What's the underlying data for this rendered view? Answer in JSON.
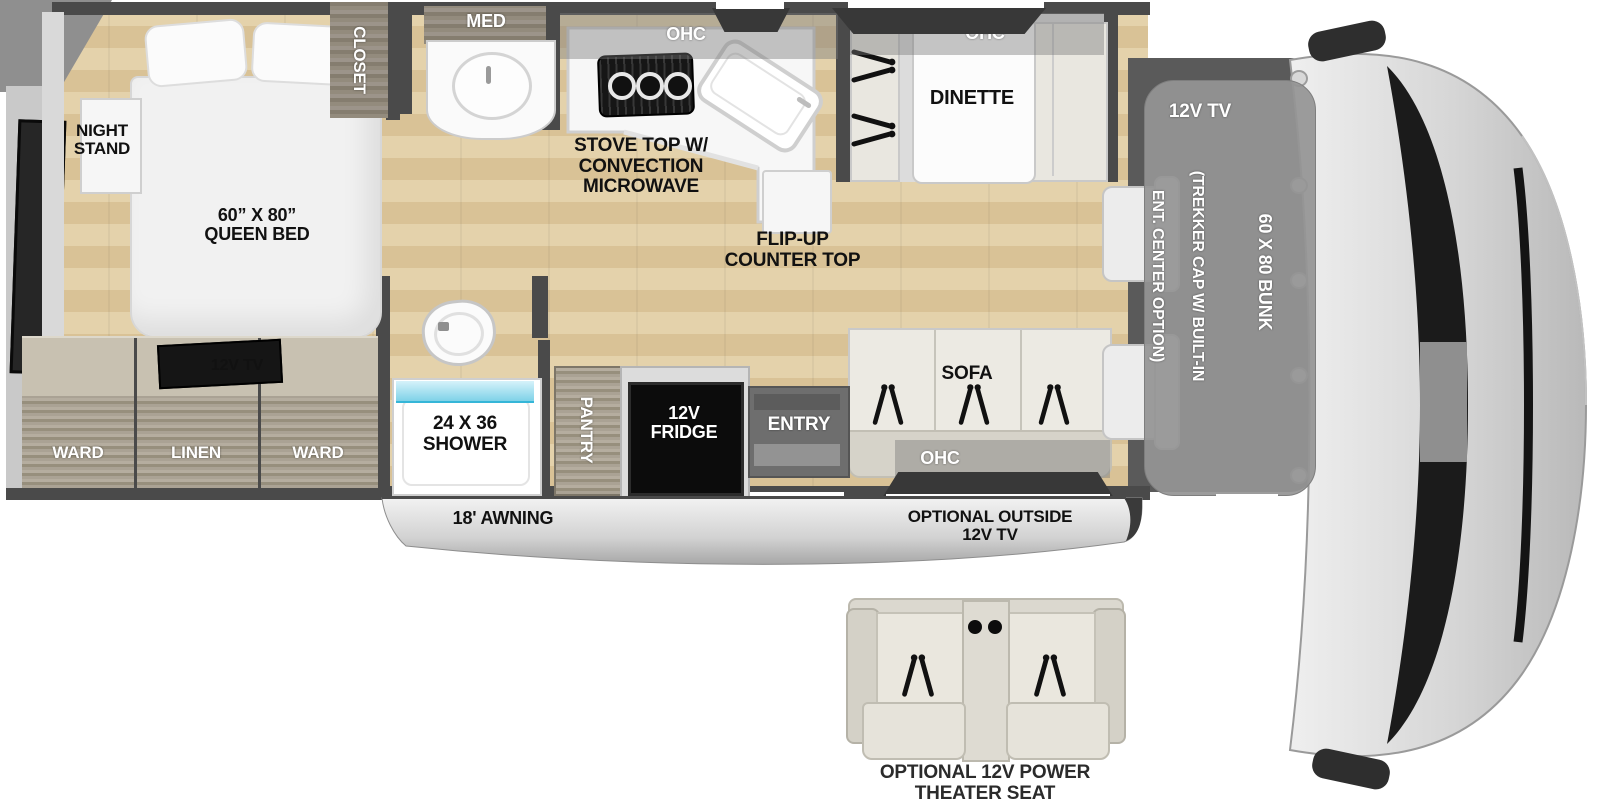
{
  "colors": {
    "wall": "#4a4a4a",
    "floor_wood": "#ddc9a0",
    "cabinet_wood": "#a29a8c",
    "shower_blue": "#9fe2f2",
    "fridge_black": "#0c0c0c",
    "bunk_gray": "#969696",
    "awning_silver": "#cfcfcf"
  },
  "bedroom": {
    "night_stand": "NIGHT STAND",
    "queen_bed_lines": [
      "60” X 80”",
      "QUEEN BED"
    ],
    "closet": "CLOSET",
    "tv": "12V TV",
    "wardrobe": [
      "WARD",
      "LINEN",
      "WARD"
    ]
  },
  "bathroom": {
    "med": "MED",
    "shower_lines": [
      "24 X 36",
      "SHOWER"
    ]
  },
  "kitchen": {
    "ohc": "OHC",
    "stove_lines": [
      "STOVE TOP W/",
      "CONVECTION",
      "MICROWAVE"
    ],
    "flip_up_lines": [
      "FLIP-UP",
      "COUNTER TOP"
    ]
  },
  "dinette": {
    "ohc": "OHC",
    "label": "DINETTE"
  },
  "galley_wall": {
    "pantry": "PANTRY",
    "fridge_lines": [
      "12V",
      "FRIDGE"
    ],
    "entry": "ENTRY"
  },
  "sofa": {
    "label": "SOFA",
    "ohc": "OHC"
  },
  "cab": {
    "tv": "12V TV",
    "note_lines": [
      "(TREKKER CAP W/ BUILT-IN",
      "ENT. CENTER OPTION)"
    ],
    "bunk": "60 X 80 BUNK"
  },
  "exterior": {
    "awning": "18' AWNING",
    "outside_tv_lines": [
      "OPTIONAL OUTSIDE",
      "12V TV"
    ]
  },
  "options": {
    "theater_lines": [
      "OPTIONAL 12V POWER",
      "THEATER SEAT"
    ]
  }
}
